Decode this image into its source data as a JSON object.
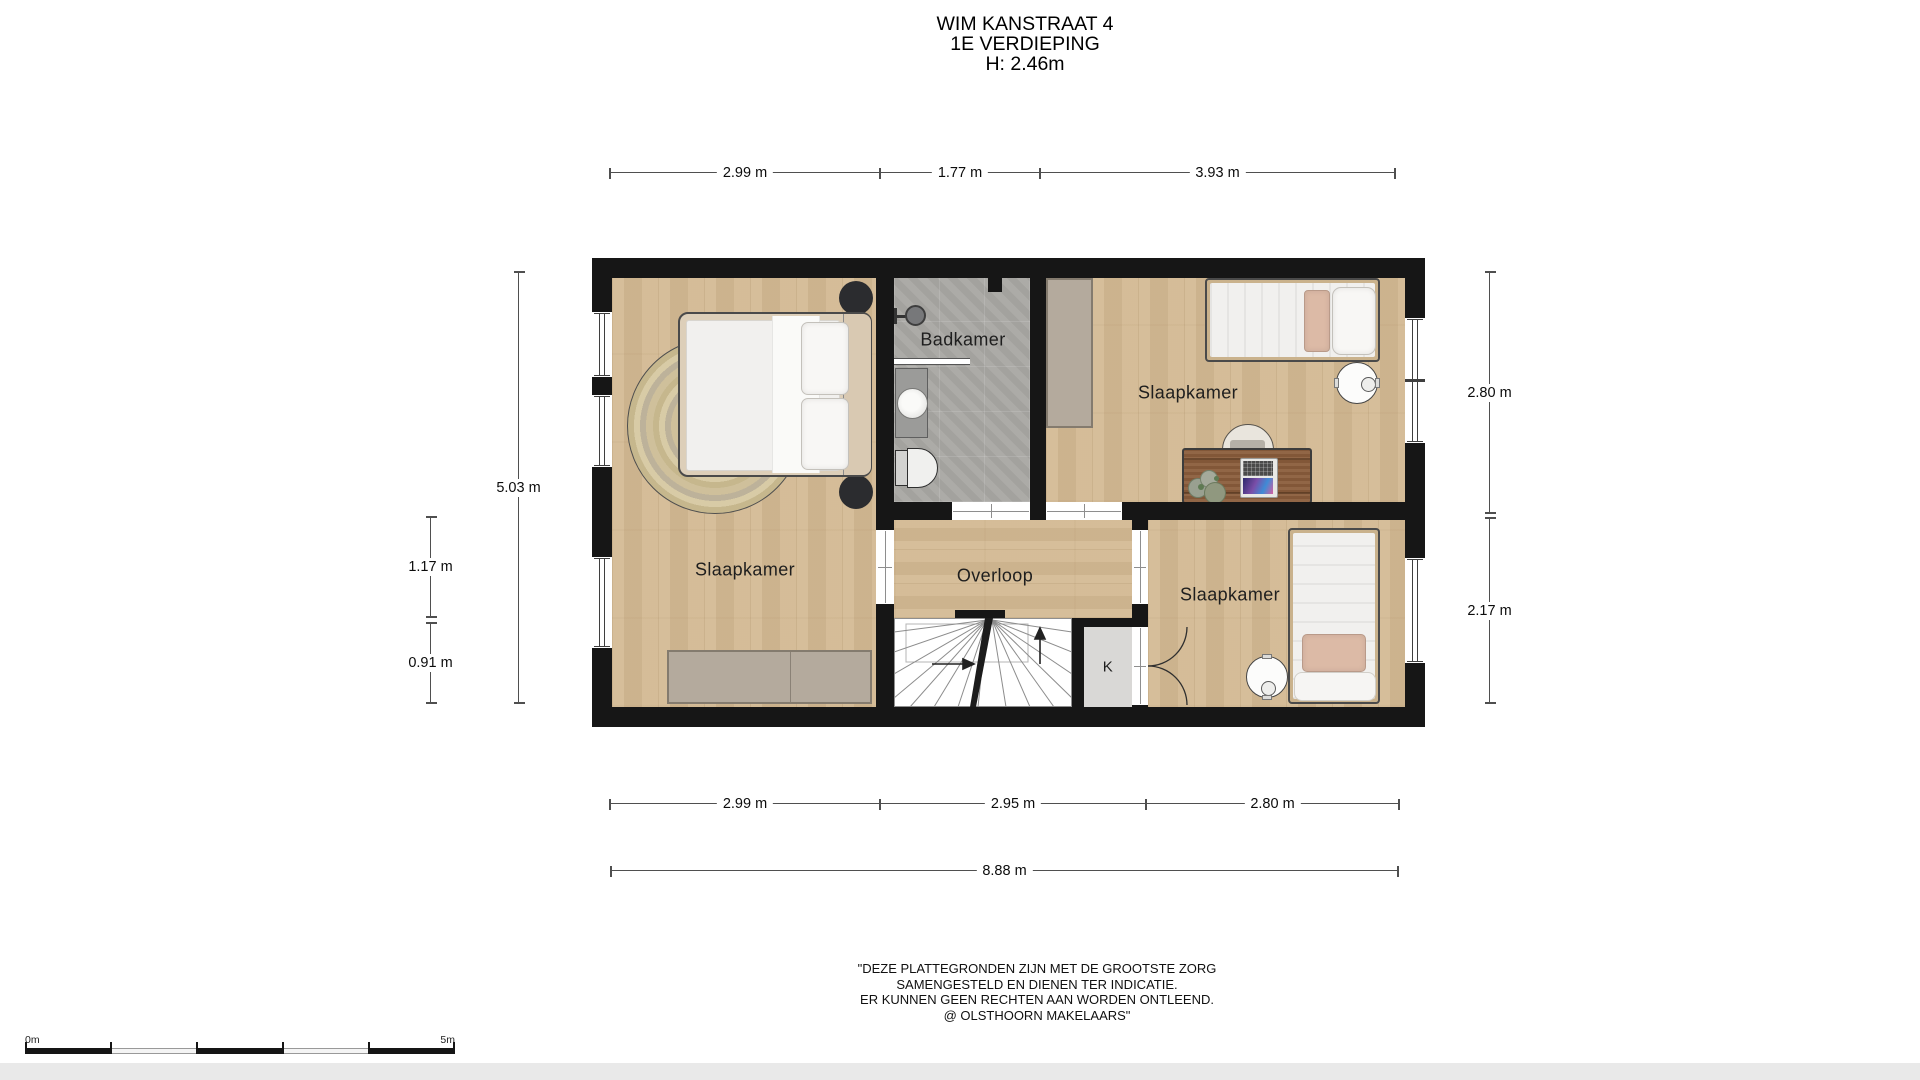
{
  "title": {
    "address": "WIM KANSTRAAT 4",
    "floor": "1E VERDIEPING",
    "ceiling_height": "H: 2.46m"
  },
  "rooms": {
    "bedroom_master": {
      "label": "Slaapkamer"
    },
    "bathroom": {
      "label": "Badkamer"
    },
    "bedroom_top_right": {
      "label": "Slaapkamer"
    },
    "landing": {
      "label": "Overloop"
    },
    "bedroom_bottom_right": {
      "label": "Slaapkamer"
    },
    "closet": {
      "label": "K"
    }
  },
  "dims": {
    "top": [
      "2.99 m",
      "1.77 m",
      "3.93 m"
    ],
    "bottom": [
      "2.99 m",
      "2.95 m",
      "2.80 m"
    ],
    "total_width": "8.88 m",
    "left_height": "5.03 m",
    "left_sub": [
      "1.17 m",
      "0.91 m"
    ],
    "right": [
      "2.80 m",
      "2.17 m"
    ]
  },
  "scale_bar": {
    "start": "0m",
    "end": "5m"
  },
  "disclaimer": [
    "\"DEZE PLATTEGRONDEN ZIJN MET DE GROOTSTE ZORG",
    "SAMENGESTELD EN DIENEN TER INDICATIE.",
    "ER KUNNEN GEEN RECHTEN AAN WORDEN ONTLEEND.",
    "@ OLSTHOORN MAKELAARS\""
  ],
  "colors": {
    "wall": "#161616",
    "wood_floor": "#d3b992",
    "tile_floor": "#a9a8a4",
    "wardrobe": "#b4aa9d",
    "desk": "#8a5c3b",
    "accent_pillow": "#dcbaa6"
  }
}
